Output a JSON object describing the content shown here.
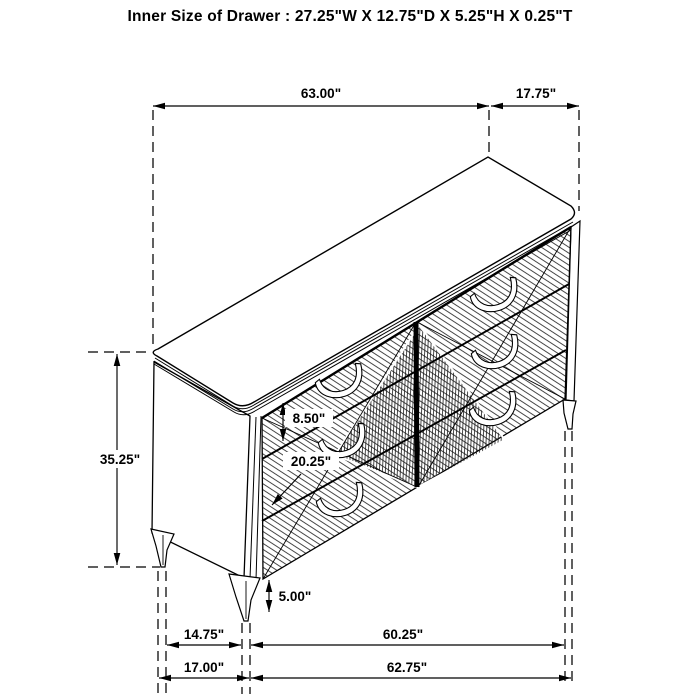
{
  "title": "Inner Size of Drawer : 27.25\"W X 12.75\"D X 5.25\"H X 0.25\"T",
  "drawing": {
    "subject": "six-drawer dresser perspective line drawing",
    "background_color": "#ffffff",
    "line_color": "#000000"
  },
  "dimensions": {
    "top_width": "63.00\"",
    "top_depth": "17.75\"",
    "overall_height": "35.25\"",
    "top_drawer_height": "8.50\"",
    "lower_drawer_section_height": "20.25\"",
    "leg_height": "5.00\"",
    "leg_span_side": "14.75\"",
    "leg_span_front": "60.25\"",
    "floor_depth": "17.00\"",
    "floor_width": "62.75\""
  }
}
